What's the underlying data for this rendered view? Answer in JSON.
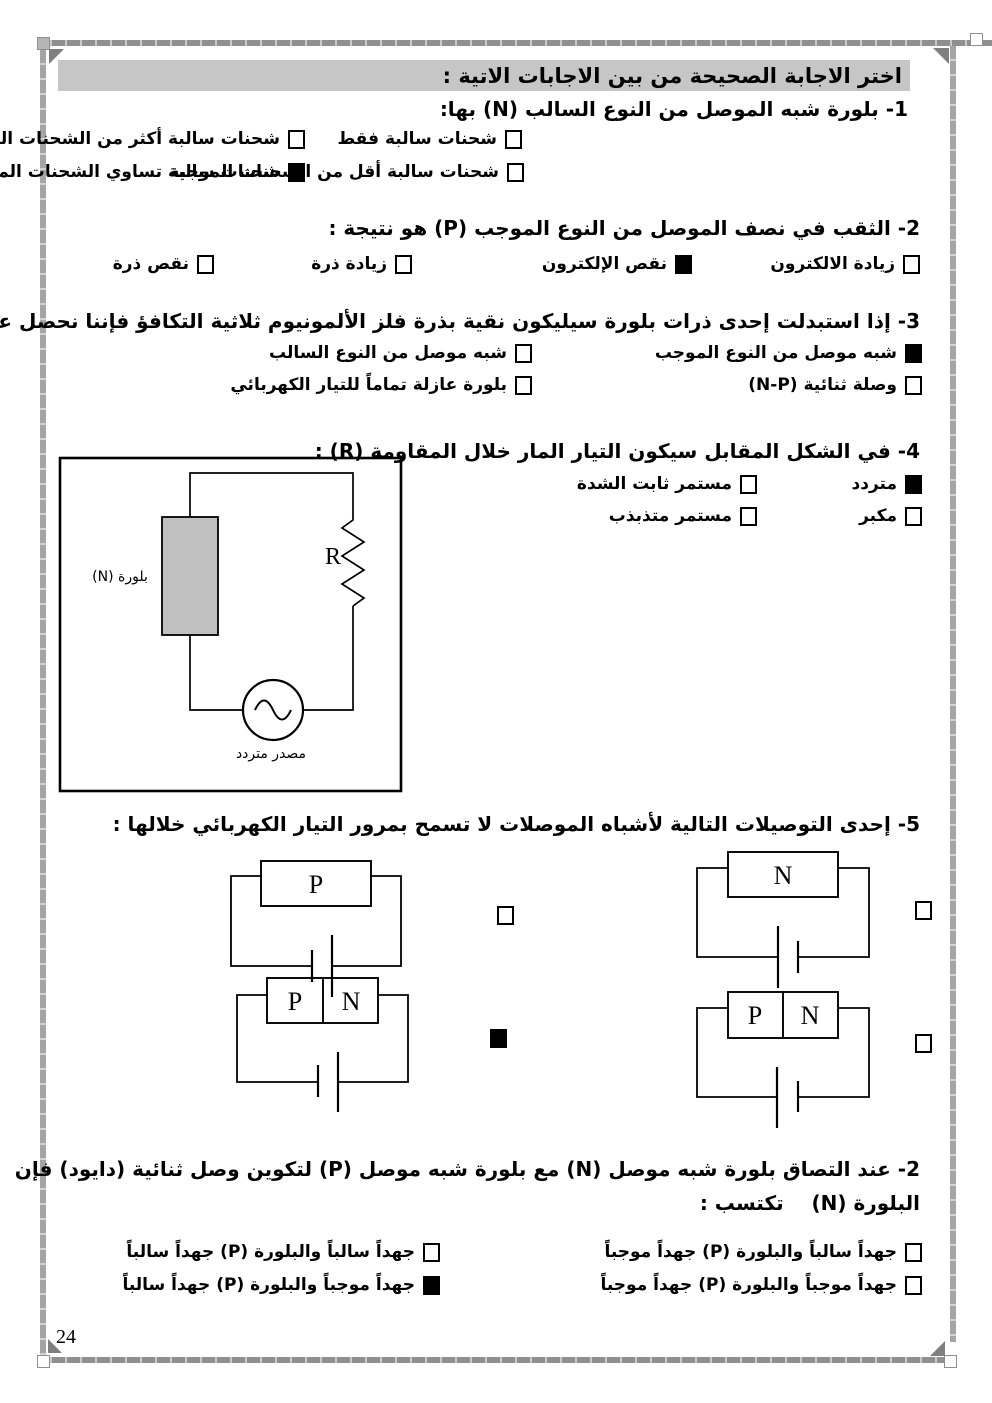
{
  "page_number": "24",
  "header": {
    "title": "اختر الاجابة الصحيحة من بين الاجابات الاتية :",
    "highlight_color": "#c6c6c6"
  },
  "questions": {
    "q1": {
      "text": "1- بلورة شبه الموصل من النوع السالب (N) بها:",
      "options": [
        {
          "label": "شحنات سالبة فقط",
          "checked": false
        },
        {
          "label": "شحنات سالبة أكثر من الشحنات الموجبة",
          "checked": false
        },
        {
          "label": "شحنات سالبة أقل من الشحنات الموجبة",
          "checked": false
        },
        {
          "label": "شحنات سالبة تساوي الشحنات الموجبة",
          "checked": true
        }
      ]
    },
    "q2": {
      "text": "2- الثقب في نصف الموصل من النوع الموجب (P) هو نتيجة :",
      "options": [
        {
          "label": "زيادة الالكترون",
          "checked": false
        },
        {
          "label": "نقص الإلكترون",
          "checked": true
        },
        {
          "label": "زيادة ذرة",
          "checked": false
        },
        {
          "label": "نقص ذرة",
          "checked": false
        }
      ]
    },
    "q3": {
      "text": "3- إذا استبدلت إحدى ذرات بلورة سيليكون نقية بذرة فلز الألمونيوم ثلاثية التكافؤ فإننا نحصل على :",
      "options": [
        {
          "label": "شبه موصل من النوع الموجب",
          "checked": true
        },
        {
          "label": "شبه موصل من النوع السالب",
          "checked": false
        },
        {
          "label": "وصلة ثنائية (N-P)",
          "checked": false
        },
        {
          "label": "بلورة عازلة تماماً للتيار الكهربائي",
          "checked": false
        }
      ]
    },
    "q4": {
      "text": "4- في الشكل المقابل سيكون التيار المار خلال المقاومة (R) :",
      "options": [
        {
          "label": "متردد",
          "checked": true
        },
        {
          "label": "مستمر ثابت الشدة",
          "checked": false
        },
        {
          "label": "مكبر",
          "checked": false
        },
        {
          "label": "مستمر متذبذب",
          "checked": false
        }
      ],
      "circuit": {
        "crystal_label": "بلورة (N)",
        "resistor_label": "R",
        "source_label": "مصدر متردد"
      }
    },
    "q5": {
      "text": "5- إحدى التوصيلات التالية لأشباه الموصلات لا تسمح بمرور التيار الكهربائي خلالها :",
      "diagrams": [
        {
          "cells": [
            "P"
          ],
          "checked": false
        },
        {
          "cells": [
            "N"
          ],
          "checked": false
        },
        {
          "cells": [
            "P",
            "N"
          ],
          "checked": true
        },
        {
          "cells": [
            "P",
            "N"
          ],
          "checked": false
        }
      ]
    },
    "q6": {
      "text_line1": "2- عند التصاق بلورة شبه موصل (N) مع بلورة شبه موصل (P) لتكوين وصل ثنائية (دايود) فإن",
      "text_line2": "البلورة (N)    تكتسب :",
      "options": [
        {
          "label": "جهداً سالباً والبلورة (P) جهداً موجباً",
          "checked": false
        },
        {
          "label": "جهداً سالباً والبلورة (P) جهداً سالباً",
          "checked": false
        },
        {
          "label": "جهداً موجباً والبلورة (P) جهداً موجباً",
          "checked": false
        },
        {
          "label": "جهداً موجباً والبلورة (P) جهداً سالباً",
          "checked": true
        }
      ]
    }
  }
}
